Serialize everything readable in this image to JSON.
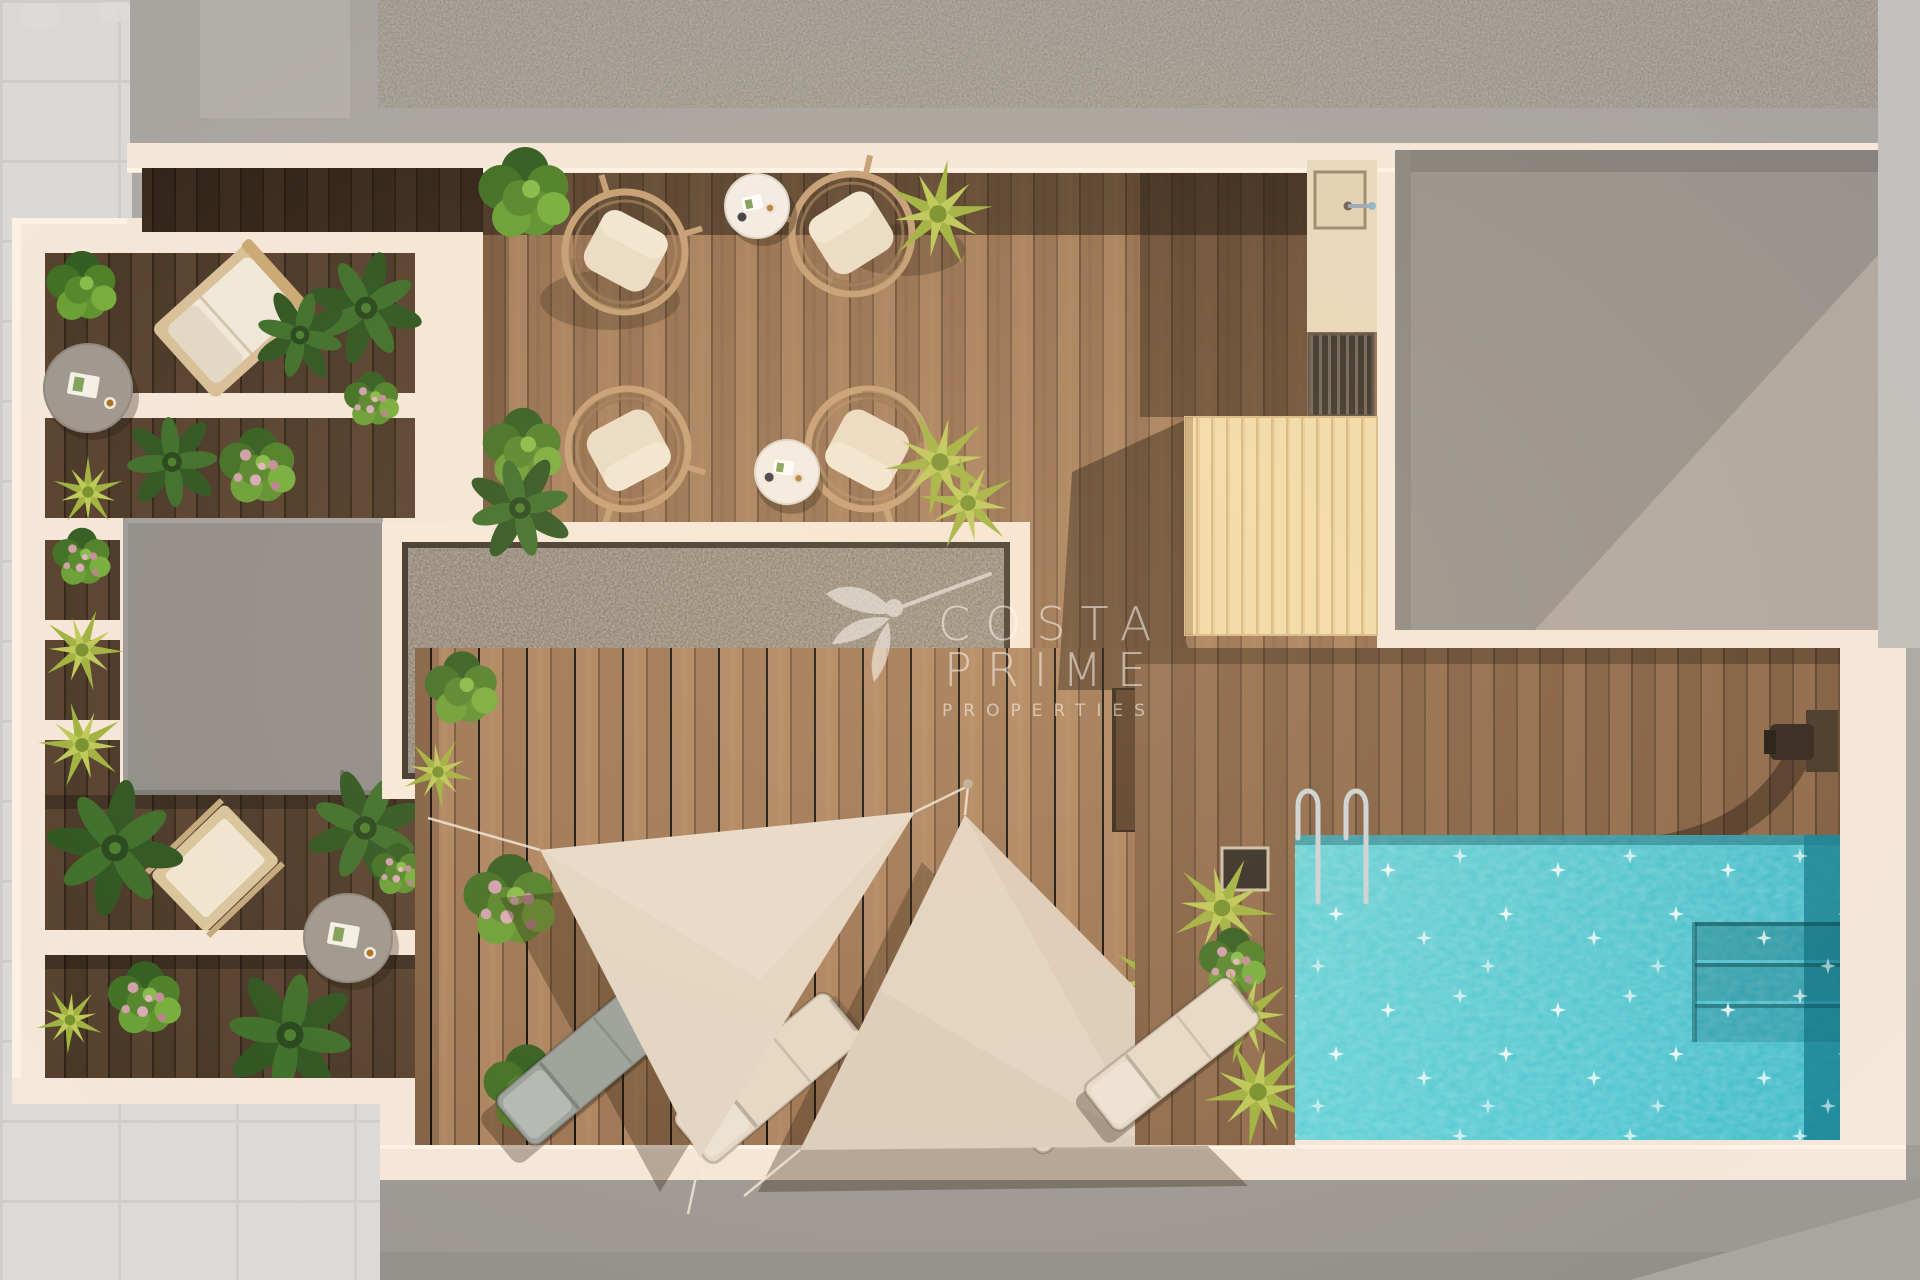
{
  "watermark": {
    "brand_line1": "COSTA",
    "brand_line2": "PRIME",
    "brand_line3": "PROPERTIES"
  },
  "scene": {
    "description": "aerial-top-view-render-of-rooftop-terrace-with-pool",
    "counts": {
      "rattan_lounge_chairs": 4,
      "white_side_tables": 2,
      "gray_round_tables": 2,
      "sun_loungers": 4,
      "shade_sails": 2,
      "day_beds": 2,
      "pool_ladders": 1,
      "outdoor_showers": 1
    },
    "features": [
      "turquoise swimming pool with corner steps",
      "wooden deck flooring",
      "two triangular shade sails",
      "slatted timber pergola roof",
      "gravel skylight panel",
      "roof access block",
      "planted balcony strips",
      "outdoor kitchenette with sink and grill",
      "timber steps to pool deck"
    ],
    "colors": {
      "pool_water": "#45c7d2",
      "pool_deep_edge": "#177f92",
      "deck_wood": "#9b7555",
      "dark_wood": "#4d3a29",
      "pool_deck_wood": "#8d6a4c",
      "cream_wall": "#f5e7d9",
      "slat_wood": "#f2dcab",
      "gravel": "#7b7265",
      "surround_gray": "#a8a4a0",
      "shade_sail": "#e0d1c1",
      "foliage_green": "#4c7a2f",
      "flower_pink": "#cf9fab",
      "sparkle": "#ffffff"
    }
  }
}
